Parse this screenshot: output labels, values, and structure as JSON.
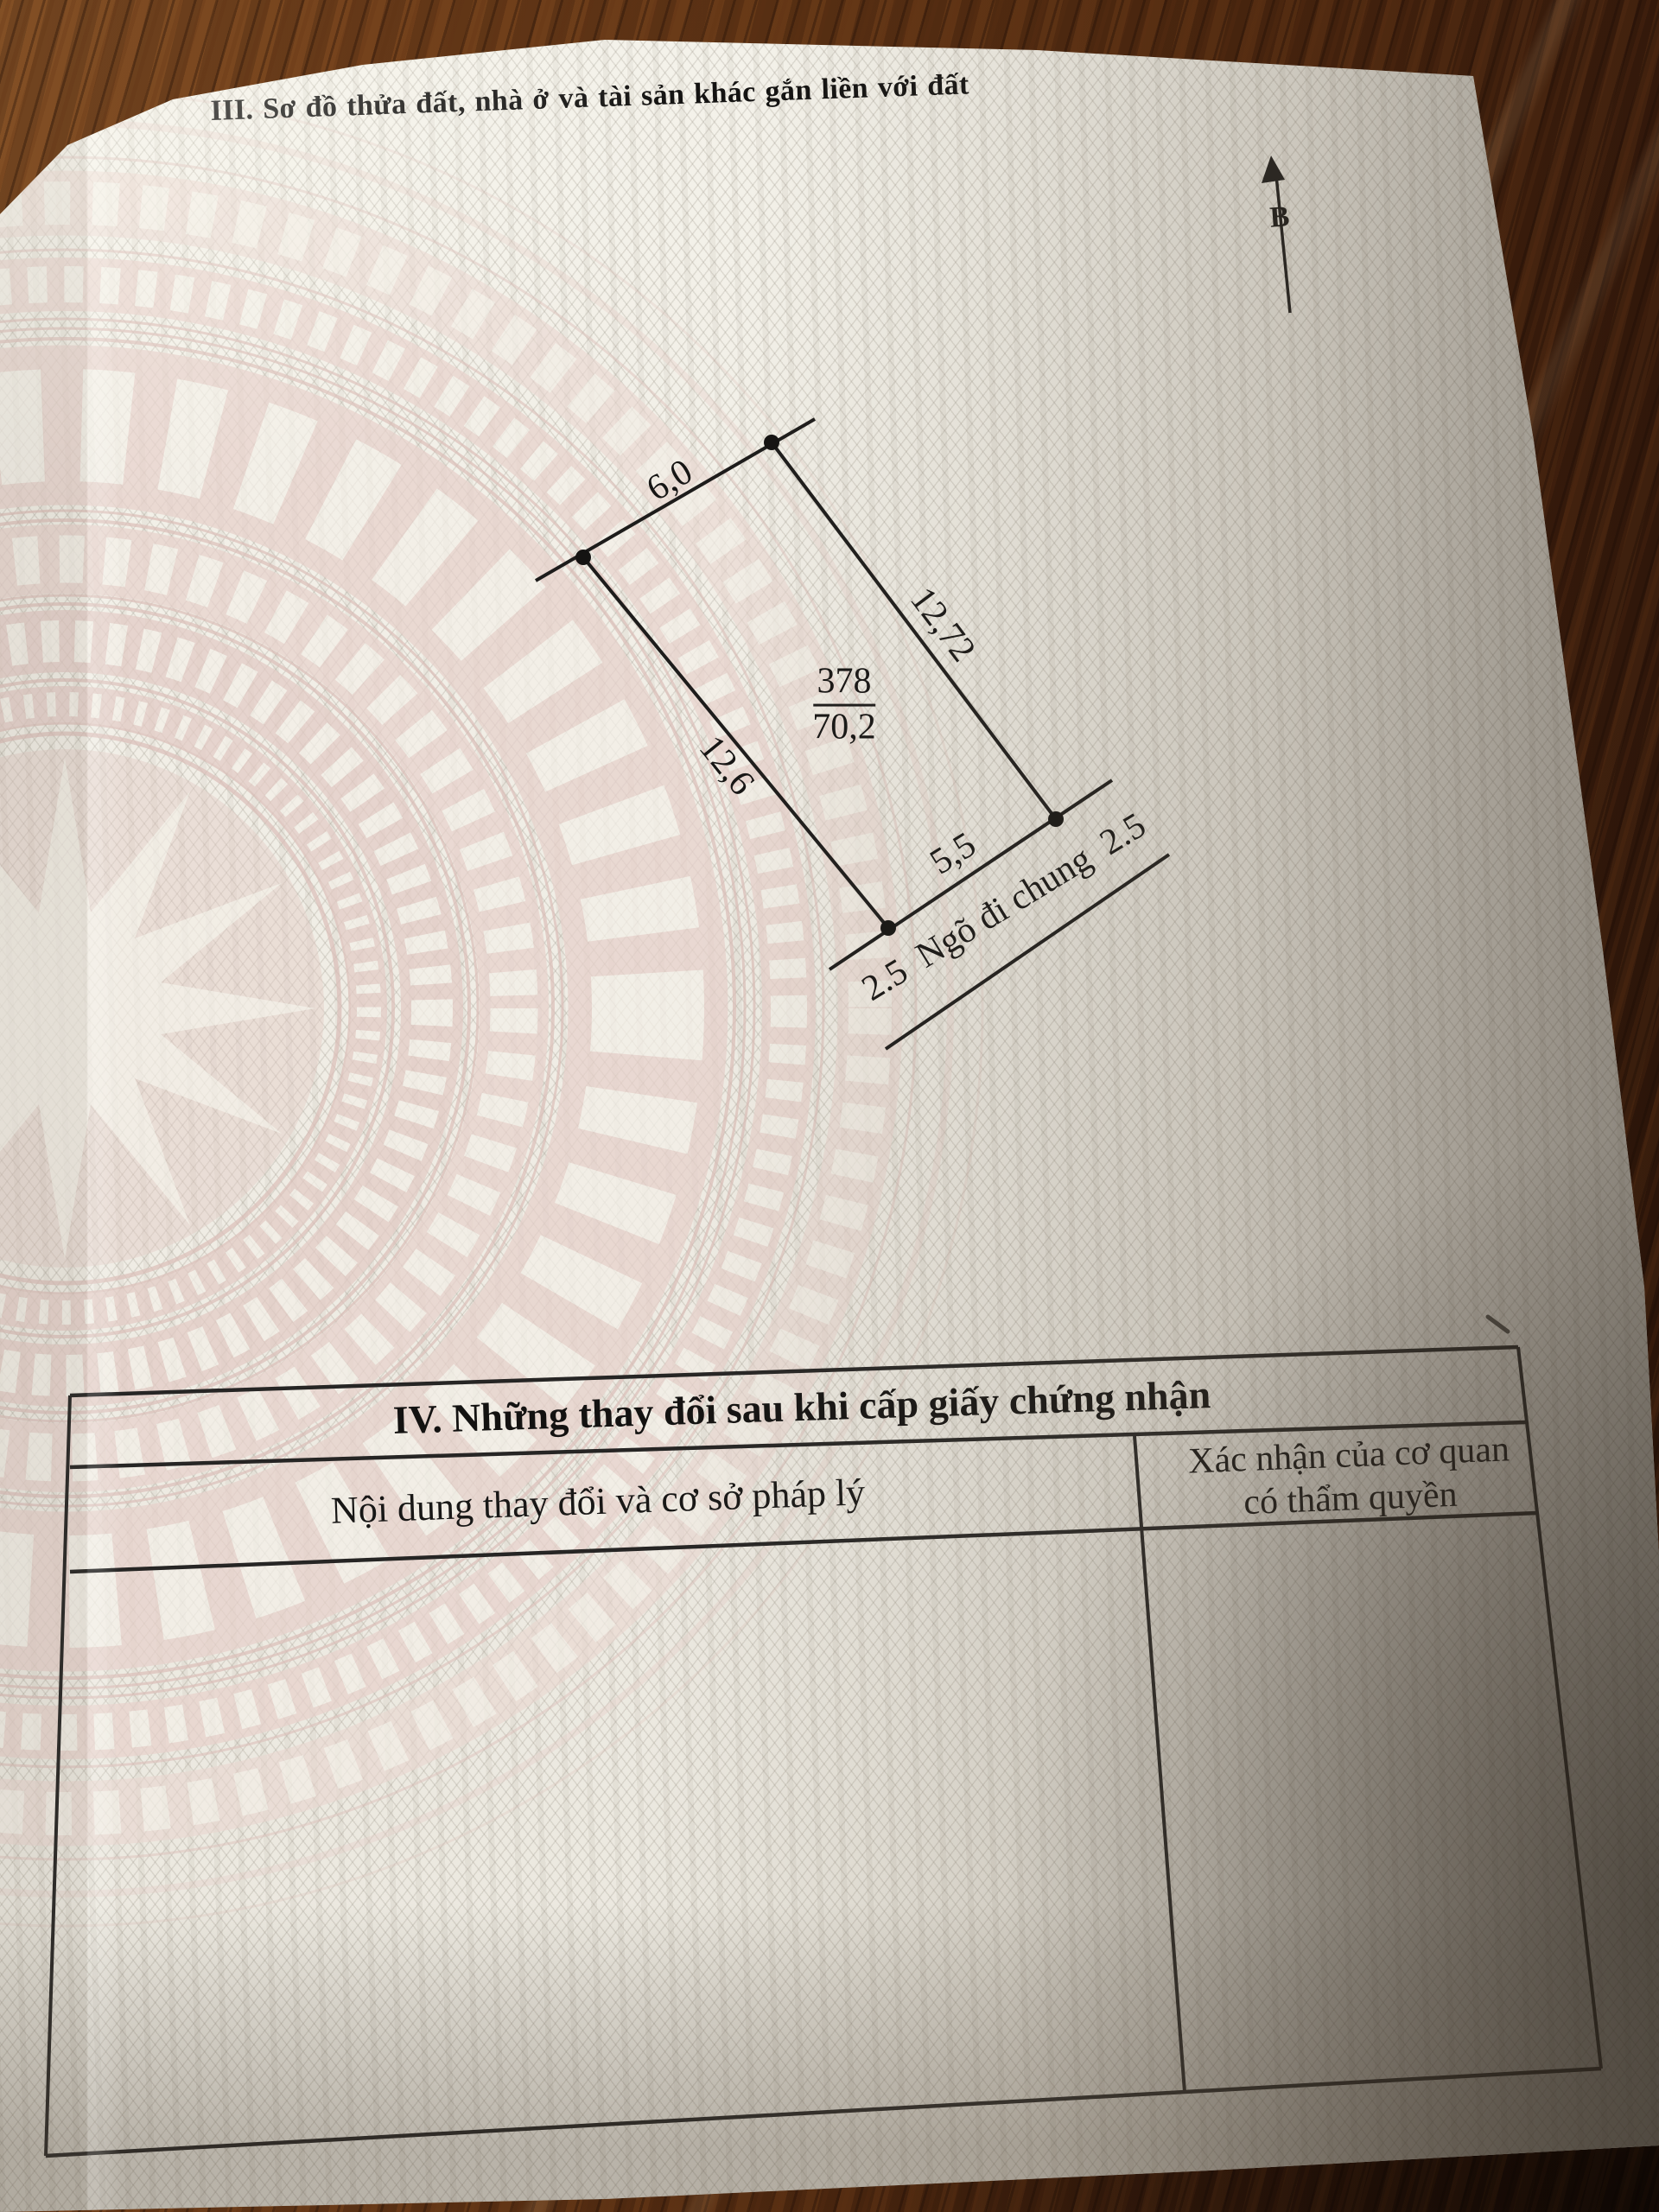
{
  "page": {
    "section3_heading": "III. Sơ đồ thửa đất, nhà ở và tài sản khác gắn liền với đất",
    "north_label": "B"
  },
  "diagram": {
    "parcel_number": "378",
    "area": "70,2",
    "edges": {
      "top": "6,0",
      "right": "12,72",
      "left": "12,6",
      "bottom": "5,5"
    },
    "alley": "2.5  Ngõ đi chung  2.5"
  },
  "table": {
    "title": "IV. Những thay đổi sau khi cấp giấy chứng nhận",
    "col_content_header": "Nội dung thay đổi và cơ sở pháp lý",
    "col_confirm_header_line1": "Xác nhận của cơ quan",
    "col_confirm_header_line2": "có thẩm quyền"
  }
}
